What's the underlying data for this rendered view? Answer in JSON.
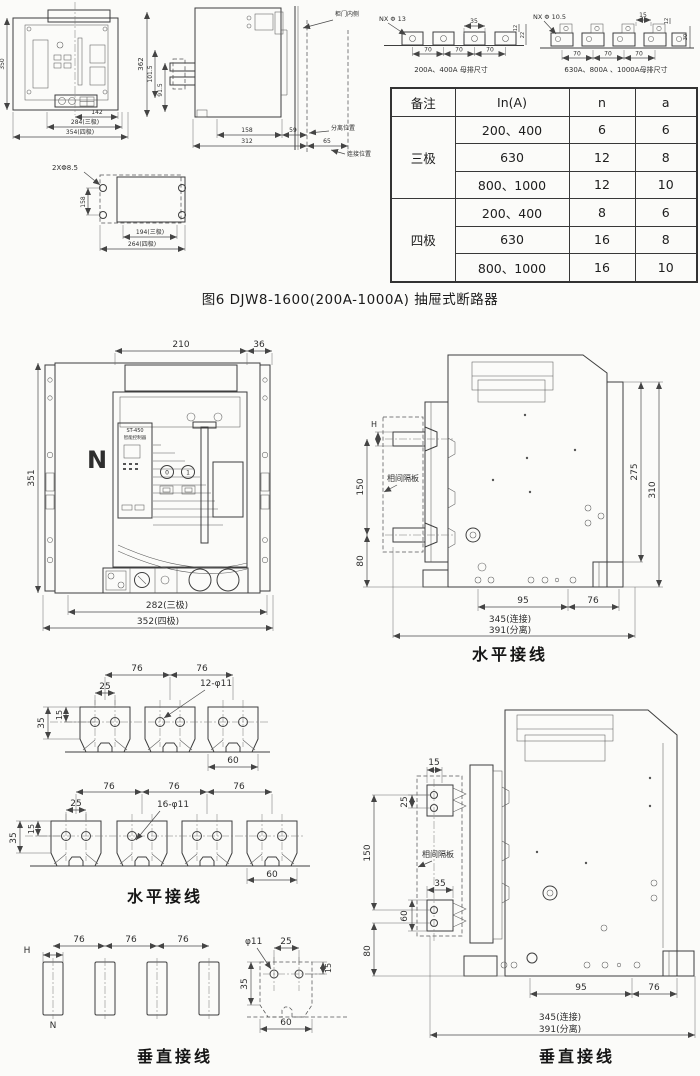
{
  "figure_caption": "图6  DJW8-1600(200A-1000A) 抽屉式断路器",
  "drawer_front": {
    "d350": "350",
    "d142": "142",
    "d284": "284(三极)",
    "d354": "354(四极)"
  },
  "drawer_side": {
    "d362": "362",
    "d101": "101.5",
    "d91": "91.5",
    "d158": "158",
    "d59": "59",
    "d312": "312",
    "d65": "65",
    "door": "柜门内侧",
    "sep": "分离位置",
    "conn": "连接位置"
  },
  "cutout": {
    "holes": "2XΦ8.5",
    "d158": "158",
    "d194": "194(三极)",
    "d264": "264(四极)"
  },
  "bus_a": {
    "label": "NX Φ 13",
    "d35": "35",
    "d70": "70",
    "d12": "12",
    "d22": "22",
    "caption": "200A、400A 母排尺寸"
  },
  "bus_b": {
    "label": "NX Φ 10.5",
    "d15": "15",
    "d70": "70",
    "d12": "12",
    "d30": "30",
    "caption": "630A、800A 、1000A母排尺寸"
  },
  "spec_table": {
    "headers": [
      "备注",
      "In(A)",
      "n",
      "a"
    ],
    "pole3": "三极",
    "pole4": "四极",
    "rows": [
      {
        "in": "200、400",
        "n": "6",
        "a": "6"
      },
      {
        "in": "630",
        "n": "12",
        "a": "8"
      },
      {
        "in": "800、1000",
        "n": "12",
        "a": "10"
      },
      {
        "in": "200、400",
        "n": "8",
        "a": "6"
      },
      {
        "in": "630",
        "n": "16",
        "a": "8"
      },
      {
        "in": "800、1000",
        "n": "16",
        "a": "10"
      }
    ]
  },
  "front": {
    "d210": "210",
    "d36": "36",
    "d351": "351",
    "d282": "282(三极)",
    "d352": "352(四极)",
    "n": "N",
    "ctrl": "ST-450",
    "ctrl2": "智能控制器",
    "b0": "0",
    "b1": "1"
  },
  "horiz": {
    "h": "H",
    "d150": "150",
    "d80": "80",
    "d275": "275",
    "d310": "310",
    "d95": "95",
    "d76": "76",
    "d345": "345(连接)",
    "d391": "391(分离)",
    "partition": "相间隔板",
    "caption": "水平接线"
  },
  "bus3": {
    "d76": "76",
    "d25": "25",
    "holes": "12-φ11",
    "d35": "35",
    "d15": "15",
    "d60": "60"
  },
  "bus4": {
    "d76": "76",
    "d25": "25",
    "holes": "16-φ11",
    "d35": "35",
    "d15": "15",
    "d60": "60",
    "caption": "水平接线"
  },
  "vbars": {
    "h": "H",
    "d76": "76",
    "n": "N",
    "caption": "垂直接线"
  },
  "vtab": {
    "hole": "φ11",
    "d25": "25",
    "d15": "15",
    "d35": "35",
    "d60": "60"
  },
  "vert": {
    "d15": "15",
    "d25": "25",
    "d150": "150",
    "d35": "35",
    "d60": "60",
    "d80": "80",
    "d95": "95",
    "d76": "76",
    "d345": "345(连接)",
    "d391": "391(分离)",
    "partition": "相间隔板",
    "caption": "垂直接线"
  }
}
